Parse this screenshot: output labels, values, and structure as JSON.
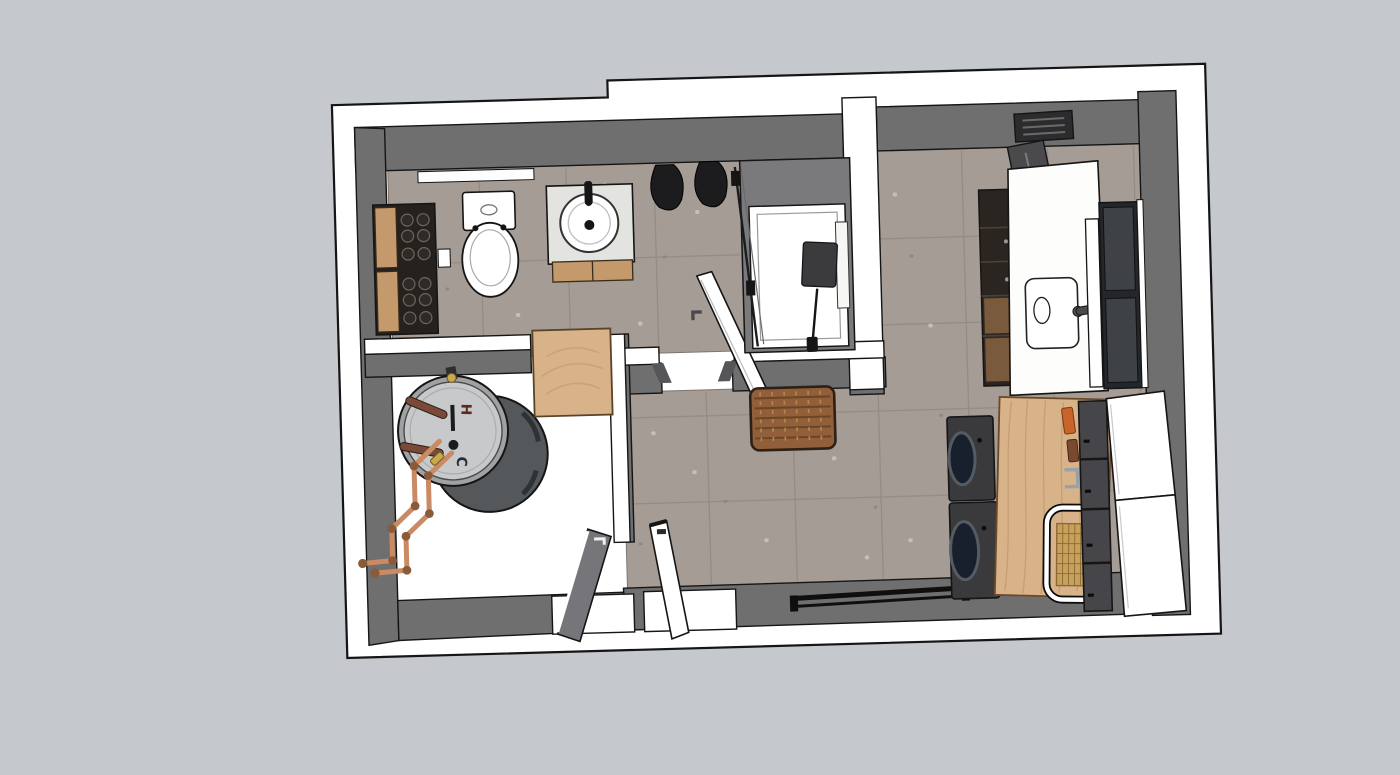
{
  "scene": {
    "description": "3D top-down SketchUp-style render of a bathroom, utility closet and laundry room floor plan",
    "labels": {
      "water_heater_hot": "H",
      "water_heater_cold": "C"
    },
    "palette": {
      "background": "#c5c8cc",
      "footprint": "#ffffff",
      "outline": "#151515",
      "wall_face": "#6f6f70",
      "wall_face_light": "#8a8a8a",
      "floor_tile": "#a59c95",
      "grout": "#948c85",
      "wood": "#d8b289",
      "wood_dark": "#c49a6c",
      "wicker": "#91603a",
      "appliance": "#3a3a3c",
      "appliance_door": "#18202e",
      "window_pane": "#3e4247",
      "copper": "#c98a64",
      "heater_top": "#c7c9ca",
      "heater_body": "#54585b",
      "towel": "#1c1c1e",
      "cane": "#c7a05c",
      "hot_label": "#5b2a1e",
      "cold_label": "#232c3a"
    }
  }
}
